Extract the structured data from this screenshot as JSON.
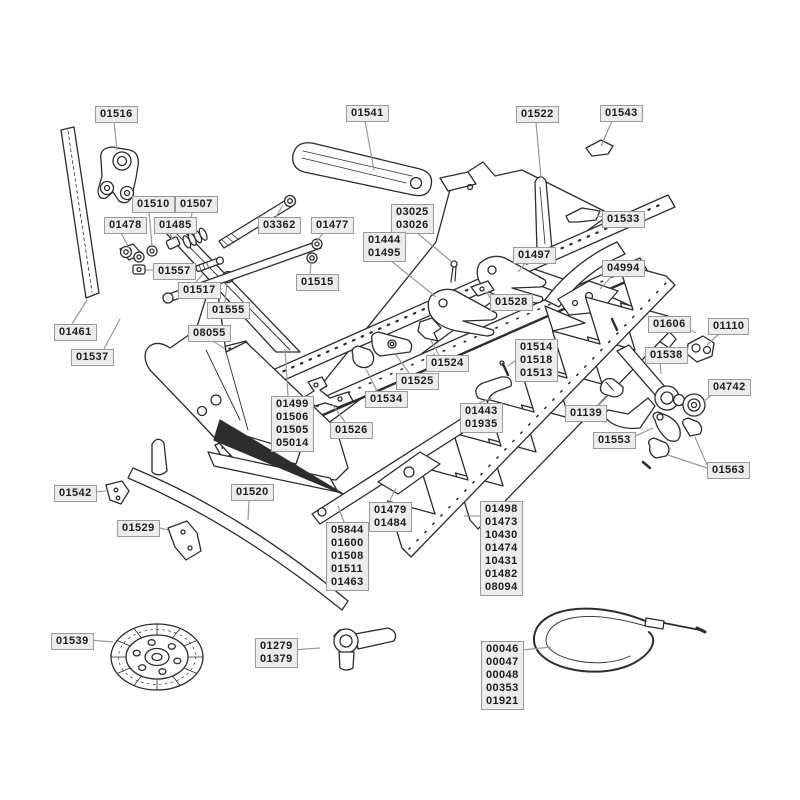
{
  "diagram": {
    "colors": {
      "background": "#ffffff",
      "line": "#2d2d2d",
      "label_bg": "#ececec",
      "label_border": "#9a9a9a",
      "label_text": "#1c1c1c",
      "leader": "#9a9a9a"
    },
    "labels": [
      {
        "id": "01516",
        "lines": [
          "01516"
        ],
        "x": 95,
        "y": 106,
        "leaders": [
          [
            114,
            122,
            117,
            150
          ]
        ]
      },
      {
        "id": "01541",
        "lines": [
          "01541"
        ],
        "x": 346,
        "y": 105,
        "leaders": [
          [
            365,
            121,
            374,
            170
          ]
        ]
      },
      {
        "id": "01522",
        "lines": [
          "01522"
        ],
        "x": 516,
        "y": 106,
        "leaders": [
          [
            536,
            122,
            541,
            178
          ]
        ]
      },
      {
        "id": "01543",
        "lines": [
          "01543"
        ],
        "x": 600,
        "y": 105,
        "leaders": [
          [
            612,
            121,
            601,
            146
          ]
        ]
      },
      {
        "id": "01510",
        "lines": [
          "01510"
        ],
        "x": 132,
        "y": 196,
        "leaders": [
          [
            149,
            212,
            152,
            246
          ]
        ]
      },
      {
        "id": "01507",
        "lines": [
          "01507"
        ],
        "x": 175,
        "y": 196,
        "leaders": [
          [
            192,
            212,
            190,
            230
          ]
        ]
      },
      {
        "id": "01478",
        "lines": [
          "01478"
        ],
        "x": 104,
        "y": 217,
        "leaders": [
          [
            121,
            233,
            129,
            248
          ]
        ]
      },
      {
        "id": "01485",
        "lines": [
          "01485"
        ],
        "x": 154,
        "y": 217,
        "leaders": [
          [
            170,
            233,
            172,
            239
          ]
        ]
      },
      {
        "id": "03362",
        "lines": [
          "03362"
        ],
        "x": 258,
        "y": 217,
        "leaders": [
          [
            276,
            217,
            283,
            205
          ]
        ]
      },
      {
        "id": "01477",
        "lines": [
          "01477"
        ],
        "x": 311,
        "y": 217,
        "leaders": [
          [
            325,
            231,
            316,
            242
          ]
        ]
      },
      {
        "id": "03025",
        "lines": [
          "03025",
          "03026"
        ],
        "x": 391,
        "y": 204,
        "leaders": [
          [
            411,
            228,
            452,
            262
          ]
        ]
      },
      {
        "id": "01533",
        "lines": [
          "01533"
        ],
        "x": 602,
        "y": 211,
        "leaders": [
          [
            602,
            217,
            597,
            216
          ]
        ]
      },
      {
        "id": "01444",
        "lines": [
          "01444",
          "01495"
        ],
        "x": 363,
        "y": 232,
        "leaders": [
          [
            385,
            256,
            436,
            297
          ]
        ]
      },
      {
        "id": "01497",
        "lines": [
          "01497"
        ],
        "x": 513,
        "y": 247,
        "leaders": [
          [
            526,
            262,
            518,
            272
          ]
        ]
      },
      {
        "id": "01557",
        "lines": [
          "01557"
        ],
        "x": 153,
        "y": 263,
        "leaders": [
          [
            153,
            270,
            146,
            270
          ]
        ]
      },
      {
        "id": "04994",
        "lines": [
          "04994"
        ],
        "x": 602,
        "y": 260,
        "leaders": [
          [
            613,
            275,
            600,
            289
          ]
        ]
      },
      {
        "id": "01517",
        "lines": [
          "01517"
        ],
        "x": 178,
        "y": 282,
        "leaders": [
          [
            196,
            282,
            203,
            274
          ]
        ]
      },
      {
        "id": "01515",
        "lines": [
          "01515"
        ],
        "x": 296,
        "y": 274,
        "leaders": [
          [
            310,
            274,
            311,
            264
          ]
        ]
      },
      {
        "id": "01555",
        "lines": [
          "01555"
        ],
        "x": 207,
        "y": 302,
        "leaders": [
          [
            225,
            302,
            227,
            283
          ]
        ]
      },
      {
        "id": "01528",
        "lines": [
          "01528"
        ],
        "x": 490,
        "y": 294,
        "leaders": [
          [
            490,
            298,
            487,
            292
          ]
        ]
      },
      {
        "id": "01461",
        "lines": [
          "01461"
        ],
        "x": 54,
        "y": 324,
        "leaders": [
          [
            72,
            324,
            87,
            300
          ]
        ]
      },
      {
        "id": "08055",
        "lines": [
          "08055"
        ],
        "x": 188,
        "y": 325,
        "leaders": [
          [
            210,
            339,
            225,
            349
          ]
        ]
      },
      {
        "id": "01606",
        "lines": [
          "01606"
        ],
        "x": 648,
        "y": 316,
        "leaders": [
          [
            679,
            324,
            696,
            333
          ]
        ]
      },
      {
        "id": "01110",
        "lines": [
          "01110"
        ],
        "x": 708,
        "y": 318,
        "leaders": [
          [
            721,
            332,
            707,
            345
          ]
        ]
      },
      {
        "id": "01537",
        "lines": [
          "01537"
        ],
        "x": 71,
        "y": 349,
        "leaders": [
          [
            104,
            349,
            120,
            319
          ]
        ]
      },
      {
        "id": "01514",
        "lines": [
          "01514",
          "01518",
          "01513"
        ],
        "x": 515,
        "y": 339,
        "leaders": [
          [
            515,
            361,
            508,
            366
          ]
        ]
      },
      {
        "id": "01538",
        "lines": [
          "01538"
        ],
        "x": 645,
        "y": 347,
        "leaders": [
          [
            660,
            361,
            661,
            374
          ]
        ]
      },
      {
        "id": "01524",
        "lines": [
          "01524"
        ],
        "x": 426,
        "y": 355,
        "leaders": [
          [
            439,
            355,
            430,
            339
          ]
        ]
      },
      {
        "id": "01525",
        "lines": [
          "01525"
        ],
        "x": 396,
        "y": 373,
        "leaders": [
          [
            409,
            373,
            396,
            355
          ]
        ]
      },
      {
        "id": "04742",
        "lines": [
          "04742"
        ],
        "x": 708,
        "y": 379,
        "leaders": [
          [
            714,
            393,
            703,
            402
          ]
        ]
      },
      {
        "id": "01534",
        "lines": [
          "01534"
        ],
        "x": 365,
        "y": 391,
        "leaders": [
          [
            377,
            391,
            366,
            369
          ]
        ]
      },
      {
        "id": "01499",
        "lines": [
          "01499",
          "01506",
          "01505",
          "05014"
        ],
        "x": 271,
        "y": 396,
        "leaders": [
          [
            288,
            396,
            285,
            349
          ]
        ]
      },
      {
        "id": "01443",
        "lines": [
          "01443",
          "01935"
        ],
        "x": 460,
        "y": 403,
        "leaders": [
          [
            479,
            403,
            492,
            398
          ]
        ]
      },
      {
        "id": "01139",
        "lines": [
          "01139"
        ],
        "x": 565,
        "y": 405,
        "leaders": [
          [
            597,
            406,
            607,
            395
          ]
        ]
      },
      {
        "id": "01526",
        "lines": [
          "01526"
        ],
        "x": 330,
        "y": 422,
        "leaders": [
          [
            345,
            422,
            332,
            404
          ]
        ]
      },
      {
        "id": "01553",
        "lines": [
          "01553"
        ],
        "x": 593,
        "y": 432,
        "leaders": [
          [
            631,
            438,
            653,
            428
          ]
        ]
      },
      {
        "id": "01563",
        "lines": [
          "01563"
        ],
        "x": 707,
        "y": 462,
        "leaders": [
          [
            707,
            468,
            668,
            455
          ],
          [
            707,
            465,
            695,
            437
          ]
        ]
      },
      {
        "id": "01542",
        "lines": [
          "01542"
        ],
        "x": 54,
        "y": 485,
        "leaders": [
          [
            93,
            492,
            106,
            491
          ]
        ]
      },
      {
        "id": "01520",
        "lines": [
          "01520"
        ],
        "x": 231,
        "y": 484,
        "leaders": [
          [
            249,
            500,
            248,
            520
          ]
        ]
      },
      {
        "id": "01479",
        "lines": [
          "01479",
          "01484"
        ],
        "x": 369,
        "y": 502,
        "leaders": [
          [
            389,
            502,
            396,
            488
          ]
        ]
      },
      {
        "id": "01529",
        "lines": [
          "01529"
        ],
        "x": 117,
        "y": 520,
        "leaders": [
          [
            156,
            527,
            168,
            530
          ]
        ]
      },
      {
        "id": "05844",
        "lines": [
          "05844",
          "01600",
          "01508",
          "01511",
          "01463"
        ],
        "x": 326,
        "y": 522,
        "leaders": [
          [
            344,
            522,
            338,
            506
          ]
        ]
      },
      {
        "id": "01498",
        "lines": [
          "01498",
          "01473",
          "10430",
          "01474",
          "10431",
          "01482",
          "08094"
        ],
        "x": 480,
        "y": 501,
        "leaders": [
          [
            480,
            516,
            464,
            516
          ]
        ]
      },
      {
        "id": "01539",
        "lines": [
          "01539"
        ],
        "x": 51,
        "y": 633,
        "leaders": [
          [
            89,
            640,
            113,
            642
          ]
        ]
      },
      {
        "id": "01279",
        "lines": [
          "01279",
          "01379"
        ],
        "x": 255,
        "y": 638,
        "leaders": [
          [
            292,
            650,
            320,
            648
          ]
        ]
      },
      {
        "id": "00046",
        "lines": [
          "00046",
          "00047",
          "00048",
          "00353",
          "01921"
        ],
        "x": 481,
        "y": 641,
        "leaders": [
          [
            522,
            650,
            551,
            647
          ]
        ]
      }
    ]
  }
}
